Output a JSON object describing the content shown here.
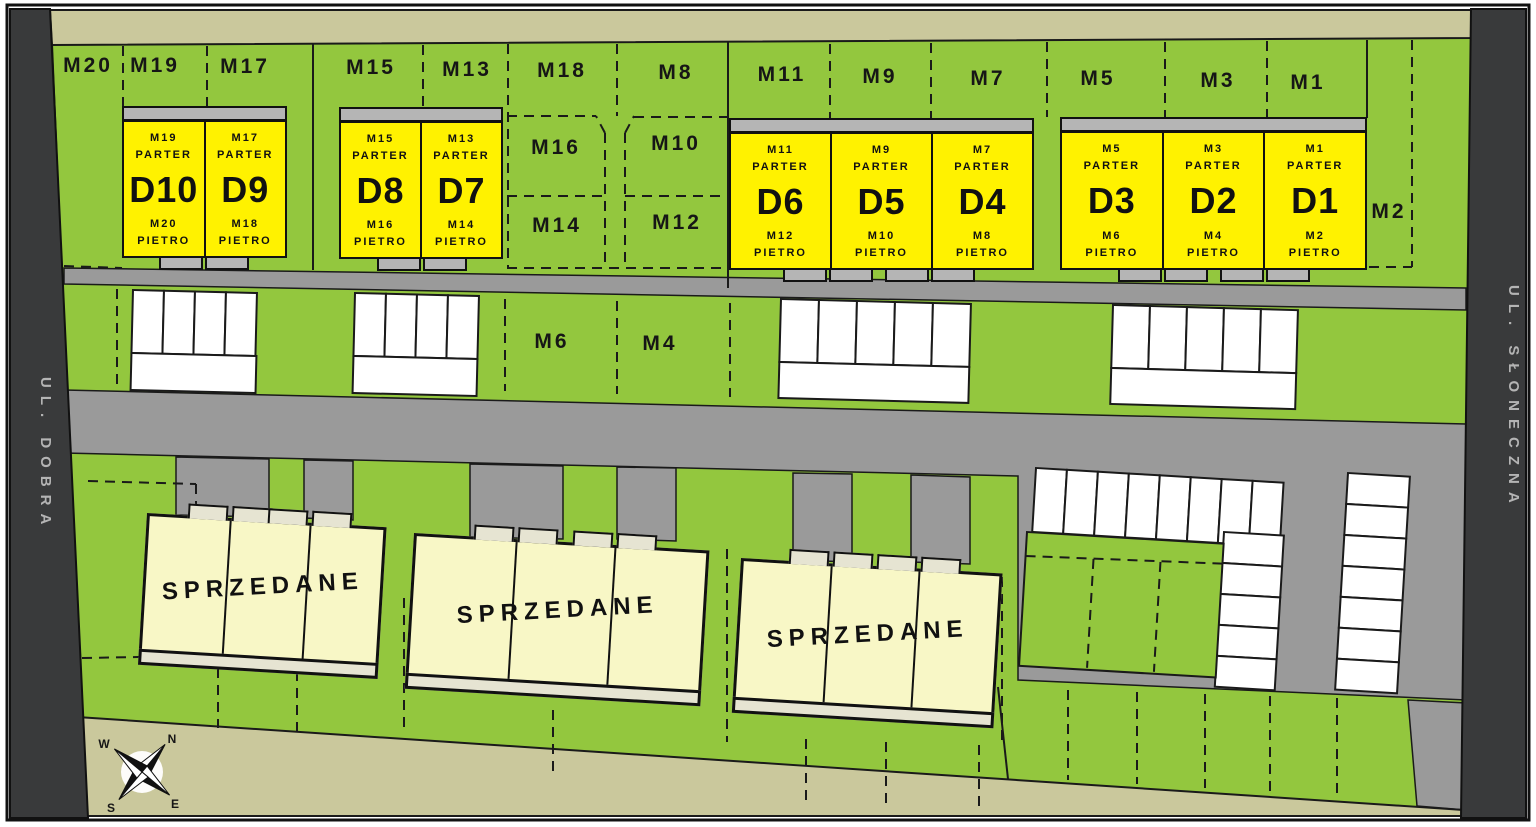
{
  "streets": {
    "left": "UL. DOBRA",
    "right": "UL. SŁONECZNA"
  },
  "compass": {
    "n": "N",
    "e": "E",
    "s": "S",
    "w": "W"
  },
  "sold": {
    "label": "SPRZEDANE"
  },
  "floors": {
    "ground": "PARTER",
    "upper": "PIETRO"
  },
  "plots": {
    "top": [
      {
        "label": "M20"
      },
      {
        "label": "M19"
      },
      {
        "label": "M17"
      },
      {
        "label": "M15"
      },
      {
        "label": "M13"
      },
      {
        "label": "M18"
      },
      {
        "label": "M8"
      },
      {
        "label": "M11"
      },
      {
        "label": "M9"
      },
      {
        "label": "M7"
      },
      {
        "label": "M5"
      },
      {
        "label": "M3"
      },
      {
        "label": "M1"
      }
    ],
    "inner": [
      {
        "label": "M16"
      },
      {
        "label": "M10"
      },
      {
        "label": "M14"
      },
      {
        "label": "M12"
      },
      {
        "label": "M2"
      },
      {
        "label": "M6"
      },
      {
        "label": "M4"
      }
    ]
  },
  "buildings": {
    "groups": [
      {
        "units": [
          {
            "name": "D10",
            "parter_plot": "M19",
            "pietro_plot": "M20"
          },
          {
            "name": "D9",
            "parter_plot": "M17",
            "pietro_plot": "M18"
          }
        ]
      },
      {
        "units": [
          {
            "name": "D8",
            "parter_plot": "M15",
            "pietro_plot": "M16"
          },
          {
            "name": "D7",
            "parter_plot": "M13",
            "pietro_plot": "M14"
          }
        ]
      },
      {
        "units": [
          {
            "name": "D6",
            "parter_plot": "M11",
            "pietro_plot": "M12"
          },
          {
            "name": "D5",
            "parter_plot": "M9",
            "pietro_plot": "M10"
          },
          {
            "name": "D4",
            "parter_plot": "M7",
            "pietro_plot": "M8"
          }
        ]
      },
      {
        "units": [
          {
            "name": "D3",
            "parter_plot": "M5",
            "pietro_plot": "M6"
          },
          {
            "name": "D2",
            "parter_plot": "M3",
            "pietro_plot": "M4"
          },
          {
            "name": "D1",
            "parter_plot": "M1",
            "pietro_plot": "M2"
          }
        ]
      }
    ]
  },
  "colors": {
    "green": "#93c73e",
    "yellow": "#fff200",
    "road": "#9a9a9a",
    "khaki": "#cac89c",
    "dark_strip": "#393a3b",
    "sold_cream": "#f8f7c6"
  }
}
